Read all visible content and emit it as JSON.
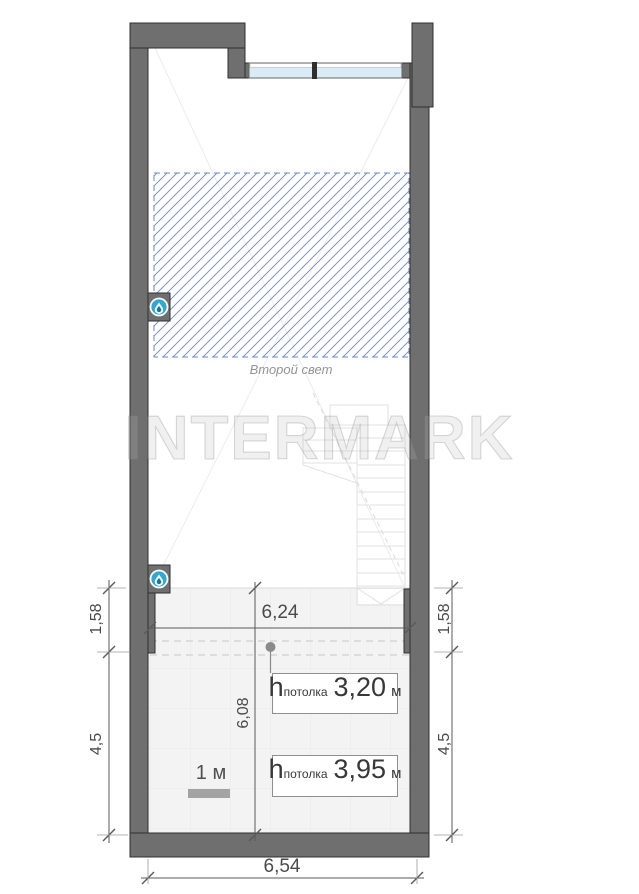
{
  "watermark": "INTERMARK",
  "labels": {
    "second_light": "Второй свет",
    "scale": "1 м"
  },
  "dimensions": {
    "width_upper": "6,24",
    "width_bottom": "6,54",
    "depth_lower_zone": "6,08",
    "left_upper": "1,58",
    "left_lower": "4,5",
    "right_upper": "1,58",
    "right_lower": "4,5"
  },
  "ceiling_heights": [
    {
      "symbol": "h",
      "subscript": "потолка",
      "value": "3,20",
      "unit": "м"
    },
    {
      "symbol": "h",
      "subscript": "потолка",
      "value": "3,95",
      "unit": "м"
    }
  ],
  "icons": {
    "wall_markers": [
      "water-drop-icon",
      "water-drop-icon"
    ]
  },
  "colors": {
    "wall": "#6f6f6f",
    "wall_outline": "#2f2f2f",
    "hatch_blue": "#6a88c2",
    "window_glass": "#d9ecf5",
    "icon_cyan": "#2fa9d2",
    "dim_line": "#5a5a5a",
    "dim_text": "#4a4a4a",
    "floor": "#f3f3f3"
  }
}
